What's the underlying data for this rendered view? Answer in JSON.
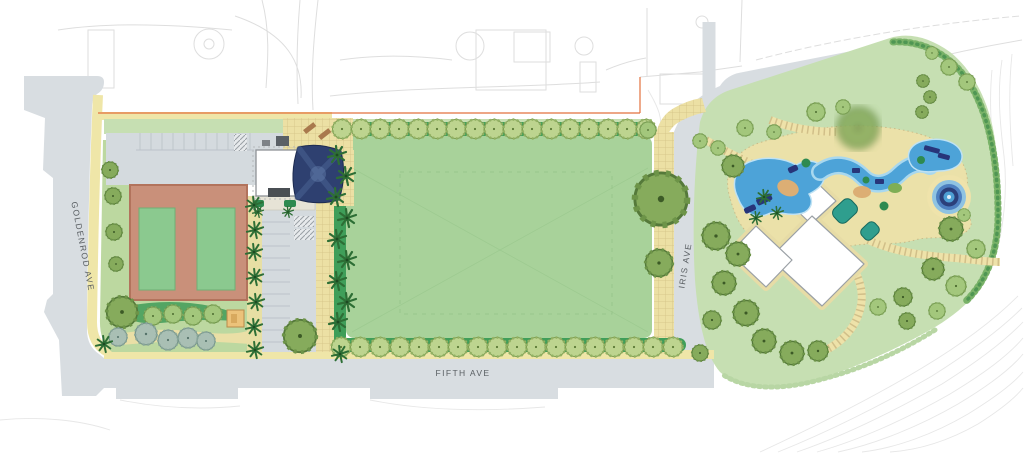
{
  "streets": {
    "goldenrod": "GOLDENROD AVE",
    "fifth": "FIFTH AVE",
    "iris": "IRIS AVE"
  },
  "palette": {
    "street_gray": "#d8dde1",
    "walk_tan": "#efe6a8",
    "lawn_green": "#c6dfb2",
    "field_green": "#a8d29a",
    "hedge_green": "#3f9e59",
    "court_clay": "#c9907a",
    "court_green": "#8bc98f",
    "water_blue": "#4da3d8",
    "slide_navy": "#27357a",
    "sand_tan": "#dcae74",
    "property_line_orange": "#e2703d",
    "label_gray": "#5a5f63"
  }
}
